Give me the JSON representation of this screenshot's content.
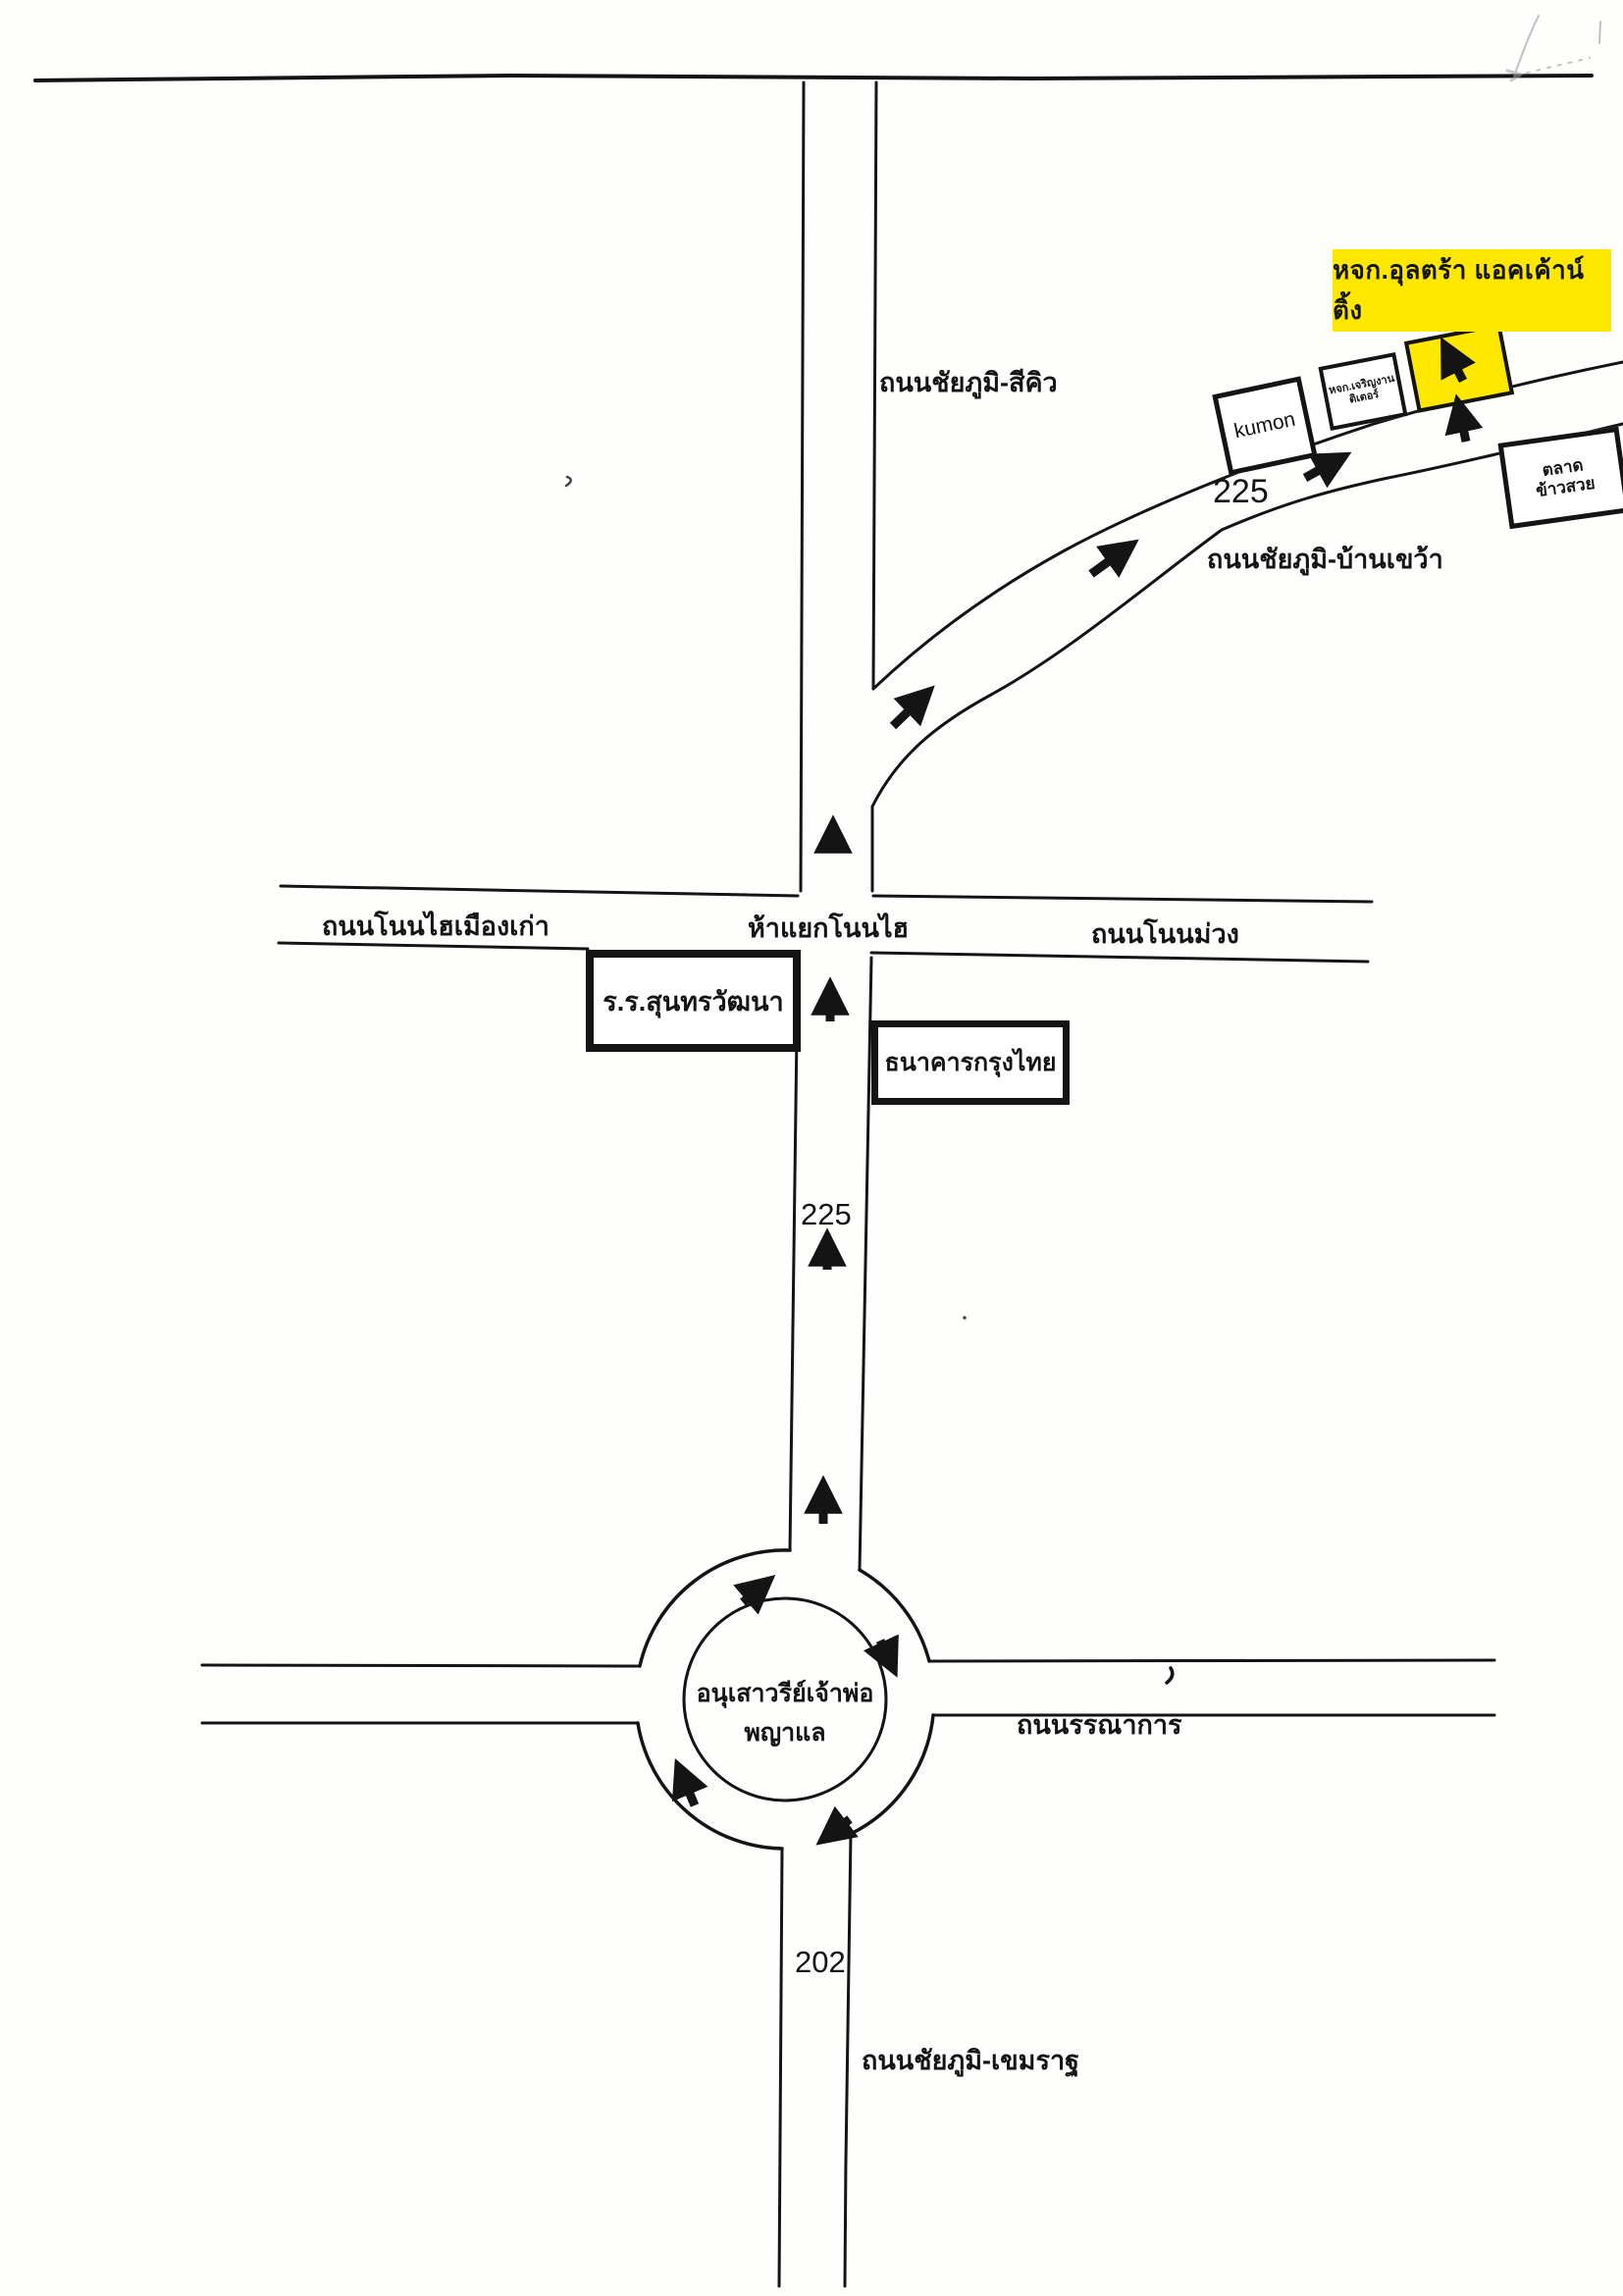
{
  "page": {
    "background": "#fefefc",
    "ink_color": "#141414",
    "highlight_color": "#ffe800"
  },
  "destination": {
    "label": "หจก.อุลตร้า แอคเค้าน์ติ้ง"
  },
  "roads": {
    "chaiyaphum_sikhio": "ถนนชัยภูมิ-สีคิว",
    "chaiyaphum_bankhwao": "ถนนชัยภูมิ-บ้านเขว้า",
    "nonhai_muangkao": "ถนนโนนไฮเมืองเก่า",
    "nonhai_junction": "ห้าแยกโนนไฮ",
    "nonmuang": "ถนนโนนม่วง",
    "bannakan": "ถนนรรณาการ",
    "chaiyaphum_khemarat": "ถนนชัยภูมิ-เขมราฐ"
  },
  "routes": {
    "highway_225_upper": "225",
    "highway_225_lower": "225",
    "highway_202": "202"
  },
  "places": {
    "kumon": "kumon",
    "charoen_shop_line1": "หจก.เจริญงาน",
    "charoen_shop_line2": "ติเตอร์",
    "market_line1": "ตลาด",
    "market_line2": "ข้าวสวย",
    "school": "ร.ร.สุนทรวัฒนา",
    "bank": "ธนาคารกรุงไทย",
    "monument_line1": "อนุเสาวรีย์เจ้าพ่อ",
    "monument_line2": "พญาแล"
  }
}
